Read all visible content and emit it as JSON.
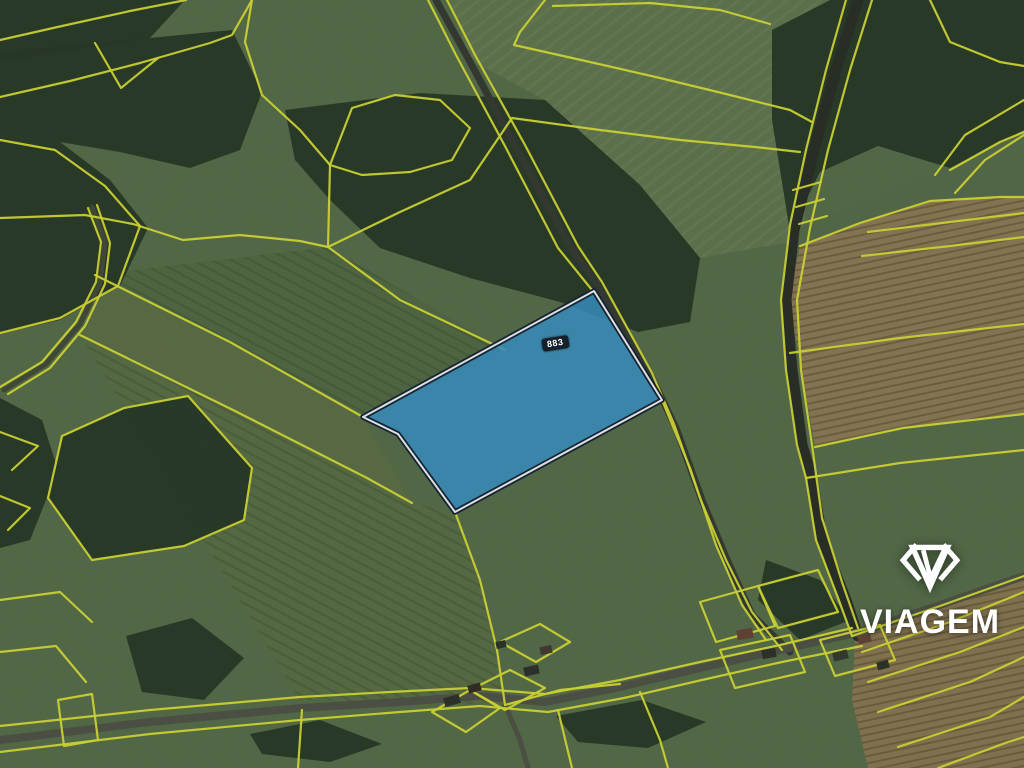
{
  "logo": {
    "text": "VIAGEM",
    "color": "#ffffff",
    "icon": "viagem-diamond-icon"
  },
  "map": {
    "background": "#5e7750",
    "cadastral_color": "#e7ee3b",
    "parcel": {
      "points": "363,417 594,291 662,400 455,512 398,434",
      "fill": "#3fa0d8",
      "fill_opacity": 0.85,
      "stroke_outer": "#16293b",
      "stroke_inner": "#ffffff",
      "label": {
        "text": "883",
        "bg": "#121a20",
        "color": "#ffffff"
      }
    },
    "layers": {
      "fields": [
        {
          "points": "450,0 830,0 802,240 700,258 640,185 545,100 470,60",
          "fill": "#6a8156"
        },
        {
          "points": "450,0 830,0 802,240 700,258 640,185 545,100 470,60",
          "fill": "url(#rows)"
        },
        {
          "points": "792,232 1024,132 1024,196 1000,197 930,201 860,223 800,246",
          "fill": "#5d7651"
        },
        {
          "points": "800,246 860,223 930,201 1000,197 1024,197 1024,414 903,428 815,447 798,350 788,300",
          "fill": "#96855e"
        },
        {
          "points": "800,246 860,223 930,201 1000,197 1024,197 1024,414 903,428 815,447 798,350 788,300",
          "fill": "url(#furrow)"
        },
        {
          "points": "855,640 940,608 1024,577 1024,768 868,768 852,700",
          "fill": "#93825b"
        },
        {
          "points": "855,640 940,608 1024,577 1024,768 868,768 852,700",
          "fill": "url(#furrow)"
        },
        {
          "points": "328,247 505,350 363,417 230,342 95,275",
          "fill": "#5a744b"
        },
        {
          "points": "328,247 505,350 363,417 230,342 95,275",
          "fill": "url(#rows2)"
        },
        {
          "points": "95,275 230,342 363,417 412,503 367,478 233,410 80,335",
          "fill": "#647a4e"
        },
        {
          "points": "412,503 455,512 480,580 497,650 505,705 300,700 80,335 233,410 367,478",
          "fill": "#62784d"
        },
        {
          "points": "412,503 455,512 480,580 497,650 505,705 300,700 80,335 233,410 367,478",
          "fill": "url(#rows2)"
        }
      ],
      "forests": [
        {
          "points": "0,0 185,0 150,38 60,52 0,62"
        },
        {
          "points": "0,52 150,38 232,30 262,92 240,150 190,168 120,152 60,142 0,136"
        },
        {
          "points": "0,136 60,142 110,180 148,228 120,286 60,320 0,334"
        },
        {
          "points": "285,110 420,93 545,100 640,185 700,258 690,322 638,332 560,302 470,278 380,248 330,200 295,160"
        },
        {
          "points": "772,30 830,0 1024,0 1024,130 950,168 878,146 820,172 790,232 772,120"
        },
        {
          "points": "0,398 42,420 58,470 30,540 0,548"
        },
        {
          "points": "48,498 62,436 124,408 188,396 252,468 244,520 184,546 92,560"
        },
        {
          "points": "126,636 192,618 244,658 204,700 142,692"
        },
        {
          "points": "250,734 320,720 382,744 330,762 262,754"
        },
        {
          "points": "556,716 642,700 706,722 648,748 578,742"
        },
        {
          "points": "766,560 820,580 850,620 800,640 758,600"
        }
      ],
      "roads": [
        {
          "points": "92,207 105,242 100,283 80,324 46,364 4,390",
          "color": "#49523f",
          "width": 5
        },
        {
          "points": "436,0 468,58 516,148 572,250 600,288 652,378 676,428 702,500 728,562 752,615 790,652",
          "color": "#3b4239",
          "width": 7
        },
        {
          "points": "858,0 836,70 814,150 794,230 786,300 792,370 802,445 812,478 822,540 846,600 858,636",
          "color": "#2f362c",
          "width": 11
        },
        {
          "points": "0,740 150,722 300,708 400,702 480,696 545,702 620,687 700,668 780,650 860,632 940,605 1024,576",
          "color": "#575c4e",
          "width": 8
        },
        {
          "points": "505,705 520,740 528,768",
          "color": "#575c4e",
          "width": 5
        }
      ],
      "lines": [
        {
          "points": "0,40 62,26 130,11 186,0"
        },
        {
          "points": "0,97 70,81 140,63 210,43 232,35 252,0"
        },
        {
          "points": "95,43 121,88 158,58"
        },
        {
          "points": "252,0 245,42 262,95 300,130 330,165 328,247"
        },
        {
          "points": "0,218 85,215 133,224 183,240 240,235 300,241 328,247"
        },
        {
          "points": "0,140 55,150 105,186 140,226 118,286 60,318 0,333"
        },
        {
          "points": "88,208 101,242 96,282 76,322 42,362 0,387"
        },
        {
          "points": "97,205 110,243 105,284 85,326 50,368 8,394"
        },
        {
          "points": "328,247 400,300 505,350"
        },
        {
          "points": "95,275 230,342 363,417"
        },
        {
          "points": "80,335 233,410 367,478 412,503"
        },
        {
          "points": "455,512 480,580 497,650 505,705"
        },
        {
          "points": "328,247 400,212 470,180 512,118 600,130 680,140 755,147 800,152"
        },
        {
          "points": "545,0 520,32 514,45 590,62 660,78 726,94 790,110 812,122"
        },
        {
          "points": "428,0 456,55 506,148 558,248 592,290"
        },
        {
          "points": "662,400 690,468 716,545 742,605 766,640"
        },
        {
          "points": "447,0 475,55 525,145 578,246 602,282 652,373 674,424 700,498 726,560 752,612 782,650"
        },
        {
          "points": "553,6 650,3 720,10 770,24"
        },
        {
          "points": "846,0 826,70 806,150 790,225 781,300 786,370 797,445 806,478 816,540 838,598 852,636"
        },
        {
          "points": "872,0 850,70 828,150 810,228 797,300 801,370 812,445 822,518 842,582 858,628"
        },
        {
          "points": "793,190 821,182"
        },
        {
          "points": "796,207 824,199"
        },
        {
          "points": "799,224 827,216"
        },
        {
          "points": "930,0 950,42 1000,62 1024,66"
        },
        {
          "points": "950,170 1000,142 1024,132"
        },
        {
          "points": "1024,100 965,135 935,175"
        },
        {
          "points": "1024,135 985,160 955,193"
        },
        {
          "points": "800,246 860,223 930,201 1000,197 1024,197"
        },
        {
          "points": "868,232 950,222 1024,213"
        },
        {
          "points": "862,256 950,246 1024,237"
        },
        {
          "points": "790,353 900,338 1024,324"
        },
        {
          "points": "815,447 903,428 1024,414"
        },
        {
          "points": "806,478 900,463 1024,450"
        },
        {
          "points": "0,726 150,710 300,697 390,692 470,688 545,694 620,680 700,662 780,645 852,628"
        },
        {
          "points": "0,752 150,734 300,720 400,712 480,706 548,712 624,698 702,680 782,662 862,646"
        },
        {
          "points": "852,636 940,606 1024,576"
        },
        {
          "points": "862,652 950,622 1024,592"
        },
        {
          "points": "868,682 960,652 1024,627"
        },
        {
          "points": "878,712 970,682 1024,657"
        },
        {
          "points": "898,747 990,717 1024,697"
        },
        {
          "points": "938,768 1008,742 1024,737"
        },
        {
          "points": "432,712 470,690 500,708 466,732 432,712"
        },
        {
          "points": "470,690 510,670 545,688 505,710 470,690"
        },
        {
          "points": "500,642 540,624 570,642 536,662 500,642"
        },
        {
          "points": "505,705 560,690 620,684"
        },
        {
          "points": "700,602 758,586 775,626 716,642 700,602"
        },
        {
          "points": "758,586 818,570 838,612 778,628 758,586"
        },
        {
          "points": "720,650 790,635 805,672 735,688 720,650"
        },
        {
          "points": "820,640 880,625 895,660 835,676 820,640"
        },
        {
          "points": "558,710 572,768"
        },
        {
          "points": "640,692 660,740 668,768"
        },
        {
          "points": "302,710 298,768"
        },
        {
          "points": "48,498 62,436 124,408 188,396 252,468 244,520 184,546 92,560 48,498"
        },
        {
          "points": "0,600 60,592 92,622"
        },
        {
          "points": "0,652 56,646 86,682"
        },
        {
          "points": "58,700 92,694 98,740 64,746 58,700"
        },
        {
          "points": "0,432 38,446 12,470"
        },
        {
          "points": "0,496 30,508 8,530"
        },
        {
          "points": "330,165 352,108 395,95 440,100 470,128 452,160 410,172 362,175 330,165"
        }
      ],
      "buildings": [
        {
          "x": 444,
          "y": 696,
          "w": 16,
          "h": 9,
          "r": -15,
          "fill": "#32382f"
        },
        {
          "x": 468,
          "y": 684,
          "w": 13,
          "h": 8,
          "r": -15,
          "fill": "#3a322c"
        },
        {
          "x": 524,
          "y": 666,
          "w": 15,
          "h": 9,
          "r": -12,
          "fill": "#32382f"
        },
        {
          "x": 540,
          "y": 646,
          "w": 12,
          "h": 8,
          "r": -12,
          "fill": "#4a423a"
        },
        {
          "x": 496,
          "y": 641,
          "w": 10,
          "h": 7,
          "r": -12,
          "fill": "#32382f"
        },
        {
          "x": 737,
          "y": 629,
          "w": 16,
          "h": 10,
          "r": -10,
          "fill": "#6e4c3b"
        },
        {
          "x": 762,
          "y": 649,
          "w": 14,
          "h": 9,
          "r": -10,
          "fill": "#32382f"
        },
        {
          "x": 833,
          "y": 651,
          "w": 15,
          "h": 9,
          "r": -14,
          "fill": "#3a4137"
        },
        {
          "x": 858,
          "y": 635,
          "w": 13,
          "h": 8,
          "r": -14,
          "fill": "#6e4c3b"
        },
        {
          "x": 877,
          "y": 661,
          "w": 12,
          "h": 8,
          "r": -14,
          "fill": "#32382f"
        }
      ]
    }
  }
}
